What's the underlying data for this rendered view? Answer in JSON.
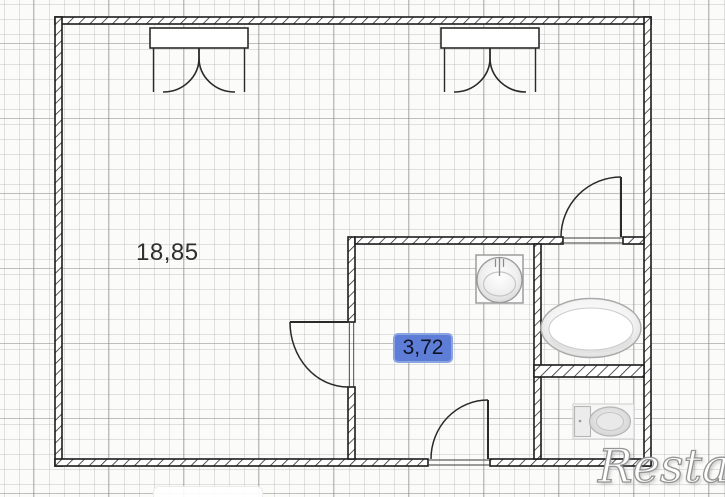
{
  "floorplan": {
    "labels": {
      "main_room_area": "18,85",
      "hall_area": "3,72"
    },
    "watermark": "Restate",
    "highlight_color": "#5d7dd6",
    "wall_color": "#1c1c1c",
    "icons": [
      "window-icon",
      "door-swing-icon",
      "sink-icon",
      "bathtub-icon",
      "toilet-icon"
    ]
  }
}
